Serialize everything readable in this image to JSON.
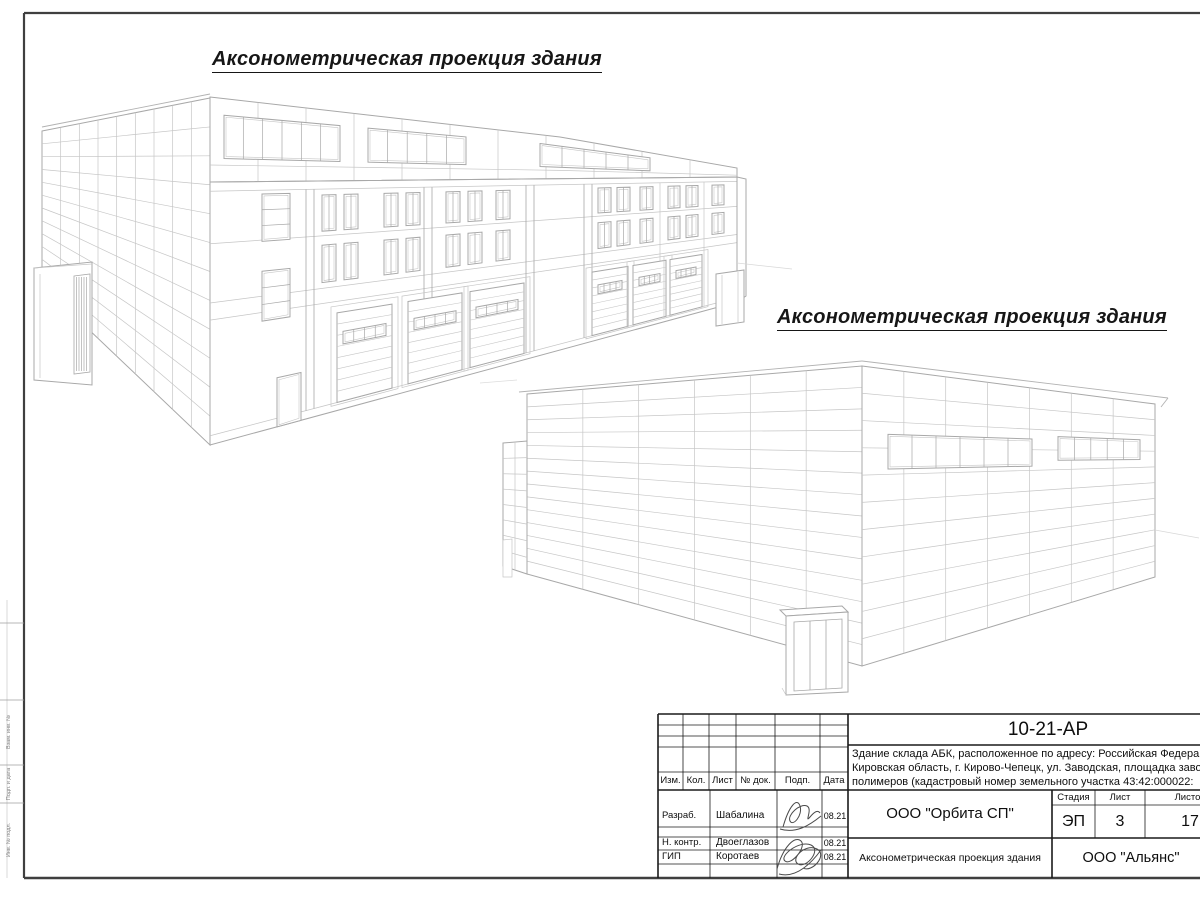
{
  "palette": {
    "background": "#ffffff",
    "frame_color": "#3f3f3f",
    "table_line_color": "#1a1a1a",
    "drawing_outline_color": "#a8a8a8",
    "drawing_grid_color": "#c6c6c6",
    "signature_color": "#4a4a4a"
  },
  "titles": {
    "top": "Аксонометрическая проекция здания",
    "middle": "Аксонометрическая проекция здания"
  },
  "margin": {
    "labels": [
      "Взам. инв. №",
      "Подп. и дата",
      "Инв. № подл."
    ]
  },
  "title_block": {
    "doc_number": "10-21-АР",
    "description_line1": "Здание склада АБК, расположенное по адресу: Российская Федерац",
    "description_line2": "Кировская область, г. Кирово-Чепецк, ул. Заводская, площадка заво",
    "description_line3": "полимеров (кадастровый номер земельного участка 43:42:000022:",
    "rev_headers": {
      "izm": "Изм.",
      "kol": "Кол.",
      "list": "Лист",
      "doc": "№ док.",
      "podp": "Подп.",
      "data": "Дата"
    },
    "roles": [
      {
        "role": "Разраб.",
        "name": "Шабалина",
        "date": "08.21"
      },
      {
        "role": "Н. контр.",
        "name": "Двоеглазов",
        "date": "08.21"
      },
      {
        "role": "ГИП",
        "name": "Коротаев",
        "date": "08.21"
      }
    ],
    "organization": "ООО \"Орбита СП\"",
    "stage": {
      "stage_label": "Стадия",
      "sheet_label": "Лист",
      "sheets_label": "Листов",
      "stage_value": "ЭП",
      "sheet_value": "3",
      "sheets_value": "17"
    },
    "drawing_caption": "Аксонометрическая проекция здания",
    "contractor": "ООО \"Альянс\""
  }
}
